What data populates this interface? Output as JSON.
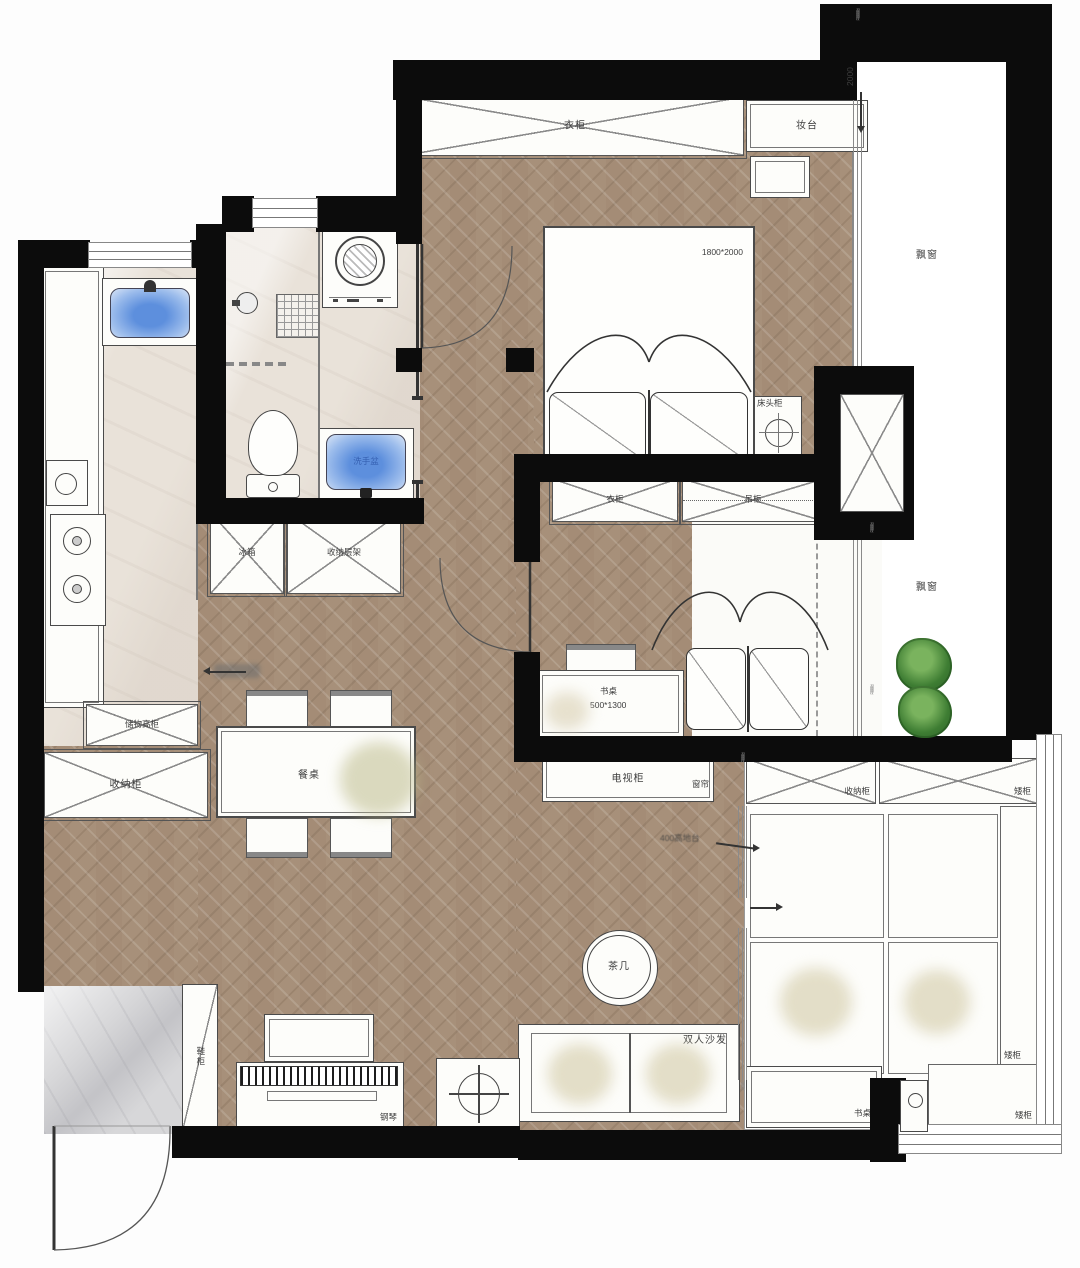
{
  "plan": {
    "labels": {
      "wardrobe": "衣柜",
      "vanity": "妆台",
      "bay_window": "飘窗",
      "bedside_table": "床头柜",
      "hanging_cabinet": "吊柜",
      "desk": "书桌",
      "fridge": "冰箱",
      "storage_shelf": "收纳层架",
      "tall_storage": "储物高柜",
      "storage_cabinet": "收纳柜",
      "dining_table": "餐桌",
      "tv_cabinet": "电视柜",
      "curtain": "窗帘",
      "low_cabinet": "矮柜",
      "tea_table": "茶几",
      "double_sofa": "双人沙发",
      "piano": "钢琴",
      "shoe_cabinet": "鞋柜",
      "washbasin": "洗手盆"
    },
    "dimensions": {
      "master_bed": "1800*2000",
      "desk": "500*1300",
      "bay_depth": "2000"
    },
    "annotations": {
      "platform_height": "400高地台"
    },
    "colors": {
      "wall": "#0c0c0c",
      "wood_floor": "#a8917b",
      "tile_floor": "#e9e2d9",
      "entry_marble": "#d7d7d9",
      "basin_blue": "#5d8fdd",
      "tree_green": "#3e7d33"
    }
  }
}
